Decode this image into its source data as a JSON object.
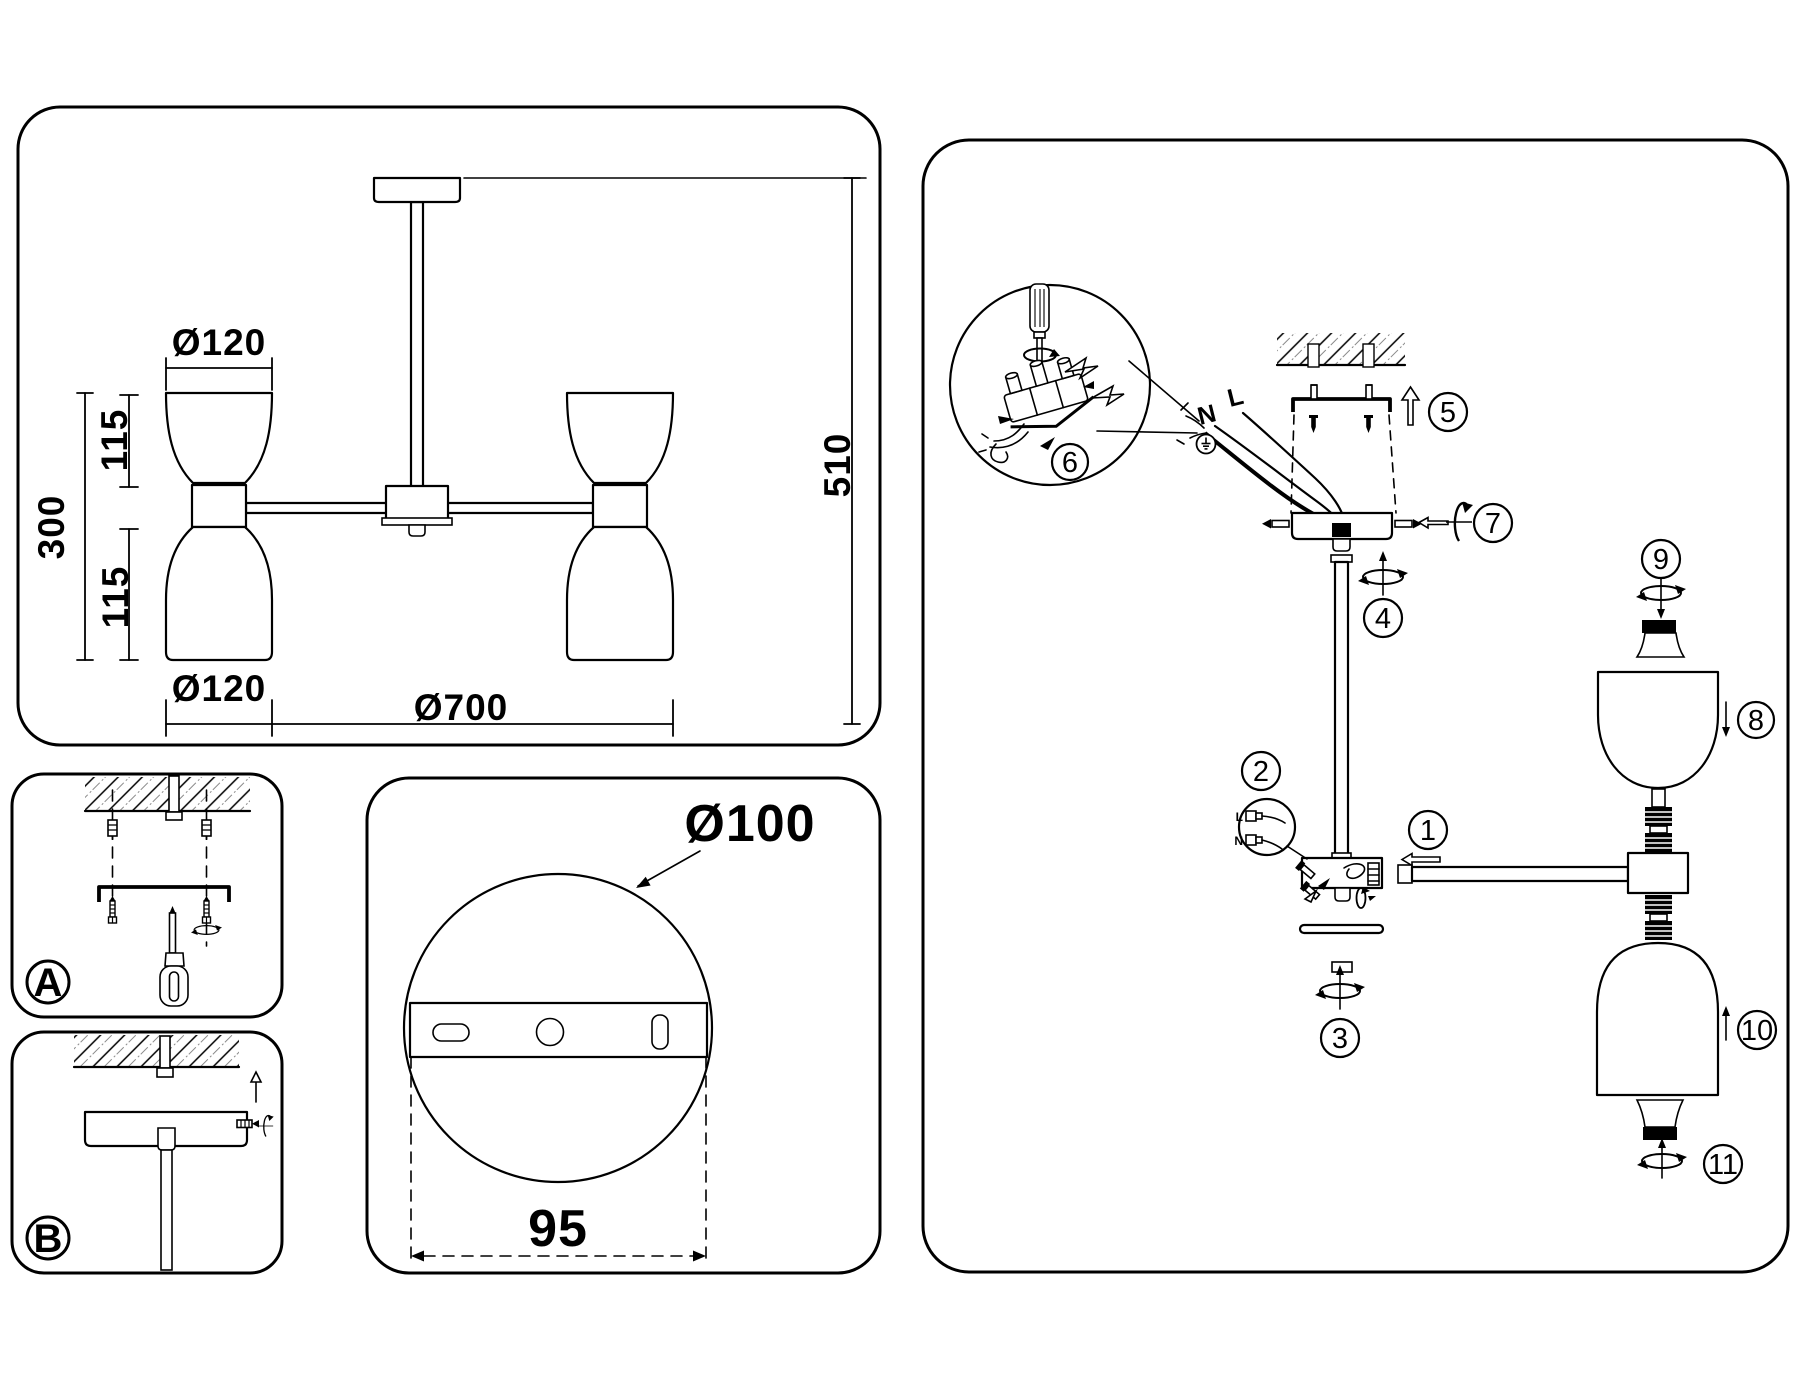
{
  "colors": {
    "line": "#000000",
    "background": "#ffffff",
    "hatch_alt": "#8a8a8a"
  },
  "panels": {
    "dimensions": {
      "dia_top": "Ø120",
      "len_upper": "115",
      "len_total": "300",
      "len_lower": "115",
      "dia_bottom": "Ø120",
      "dia_overall": "Ø700",
      "height_overall": "510"
    },
    "mounting_plate": {
      "diameter": "Ø100",
      "hole_spacing": "95"
    },
    "detail_a": {
      "label": "A"
    },
    "detail_b": {
      "label": "B"
    },
    "assembly": {
      "steps": [
        "1",
        "2",
        "3",
        "4",
        "5",
        "6",
        "7",
        "8",
        "9",
        "10",
        "11"
      ],
      "wiring": {
        "neutral": "N",
        "live": "L",
        "plug_live": "L",
        "plug_neutral": "N"
      }
    }
  }
}
